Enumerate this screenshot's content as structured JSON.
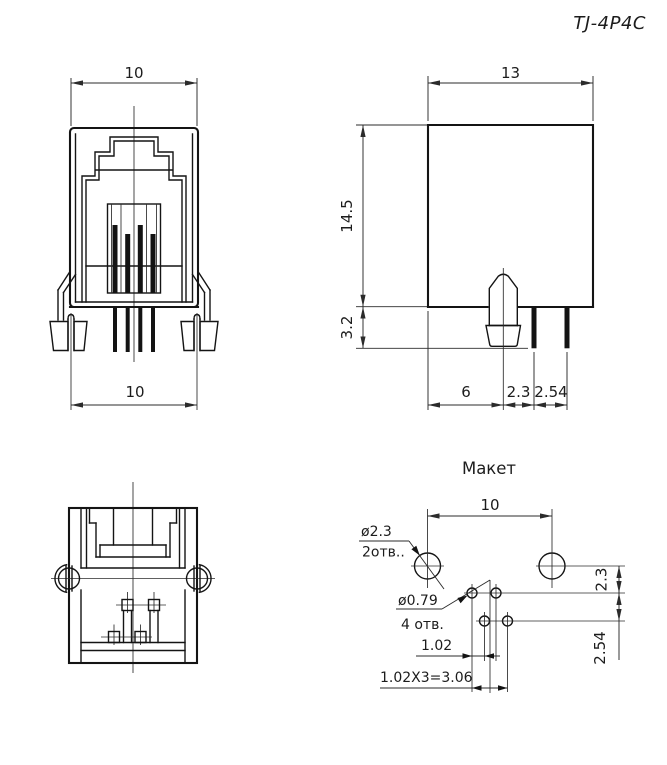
{
  "drawing_title": "TJ-4P4C",
  "front_view": {
    "dim_width_top": "10",
    "dim_width_bottom": "10"
  },
  "side_view": {
    "dim_depth": "13",
    "dim_height": "14.5",
    "dim_standoff": "3.2",
    "dim_latch_offset": "6",
    "dim_pin1_offset": "2.3",
    "dim_pin_pitch": "2.54"
  },
  "pcb_layout": {
    "title": "Макет",
    "dim_lock_pitch": "10",
    "lock_hole_dia": "ø2.3",
    "lock_hole_count": "2отв..",
    "pin_hole_dia": "ø0.79",
    "pin_hole_count": "4 отв.",
    "dim_row_offset": "2.3",
    "dim_row_pitch": "2.54",
    "dim_stagger": "1.02",
    "dim_span_total": "1.02X3=3.06"
  }
}
